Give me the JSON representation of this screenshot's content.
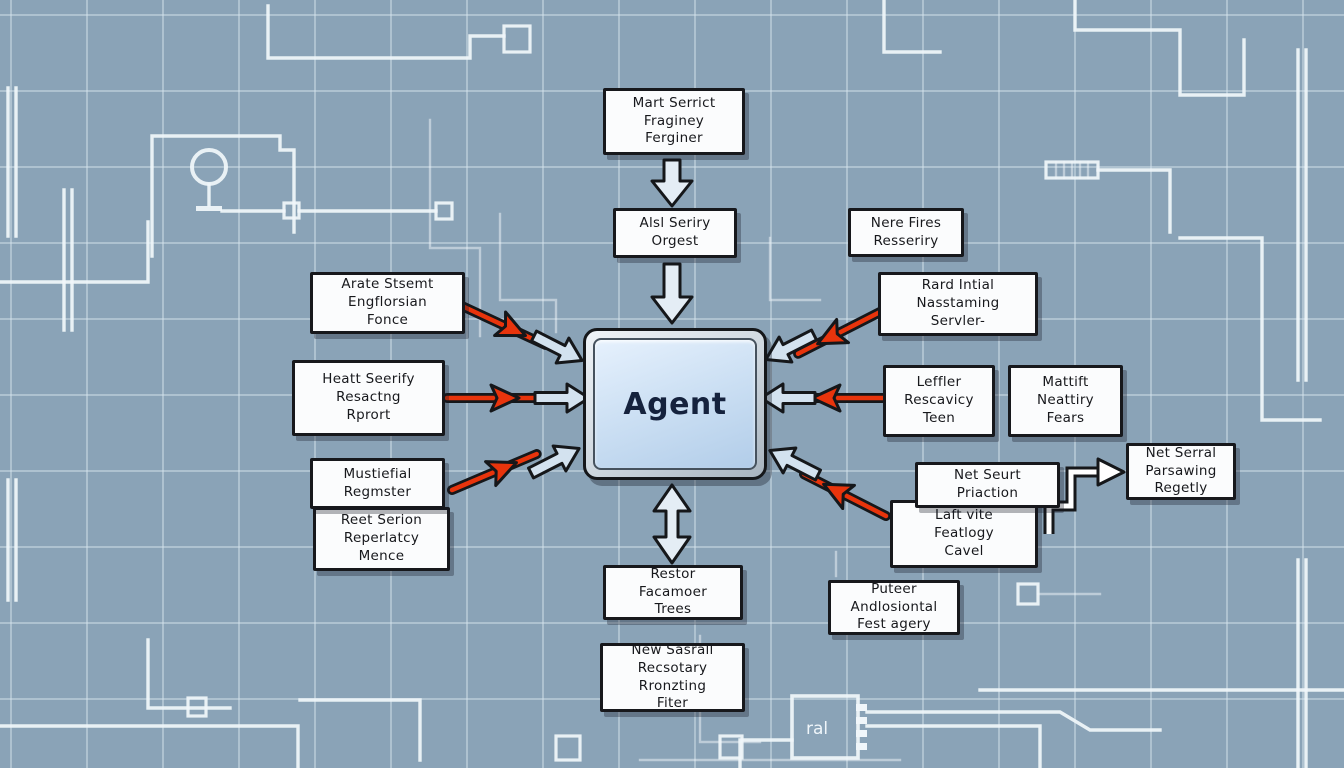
{
  "diagram": {
    "agent": {
      "label": "Agent"
    },
    "nodes": [
      {
        "id": "mart-serrict",
        "label": "Mart Serrict\nFraginey\nFerginer"
      },
      {
        "id": "alsl-seriry",
        "label": "Alsl Seriry\nOrgest"
      },
      {
        "id": "arate-stsemt",
        "label": "Arate Stsemt\nEngflorsian\nFonce"
      },
      {
        "id": "heatt-seerify",
        "label": "Heatt Seerify\nResactng\nRprort"
      },
      {
        "id": "mustiefial",
        "label": "Mustiefial\nRegmster"
      },
      {
        "id": "reet-serion",
        "label": "Reet Serion\nReperlatcy\nMence"
      },
      {
        "id": "nere-fires",
        "label": "Nere Fires\nResseriry"
      },
      {
        "id": "rard-intial",
        "label": "Rard Intial\nNasstaming\nServler-"
      },
      {
        "id": "leffler",
        "label": "Leffler\nRescavicy\nTeen"
      },
      {
        "id": "mattift",
        "label": "Mattift\nNeattiry\nFears"
      },
      {
        "id": "laft-vite",
        "label": "Laft vite\nFeatlogy\nCavel"
      },
      {
        "id": "net-seurt",
        "label": "Net Seurt\nPriaction"
      },
      {
        "id": "net-serral",
        "label": "Net Serral\nParsawing\nRegetly"
      },
      {
        "id": "restor",
        "label": "Restor\nFacamoer\nTrees"
      },
      {
        "id": "new-sasrall",
        "label": "New Sasrall\nRecsotary\nRronzting\nFiter"
      },
      {
        "id": "puteer",
        "label": "Puteer\nAndlosiontal\nFest agery"
      }
    ],
    "decor": {
      "chip_label": "ral"
    },
    "colors": {
      "background": "#8aa3b7",
      "grid_line": "#d5e3ed",
      "box_fill": "#fbfcfd",
      "box_border": "#17181c",
      "agent_fill": "#c7dcf2",
      "agent_frame": "#cdd6de",
      "arrow_red": "#e8340c",
      "arrow_blue": "#d3e2ef",
      "trace_white": "#f0f6fa"
    }
  }
}
